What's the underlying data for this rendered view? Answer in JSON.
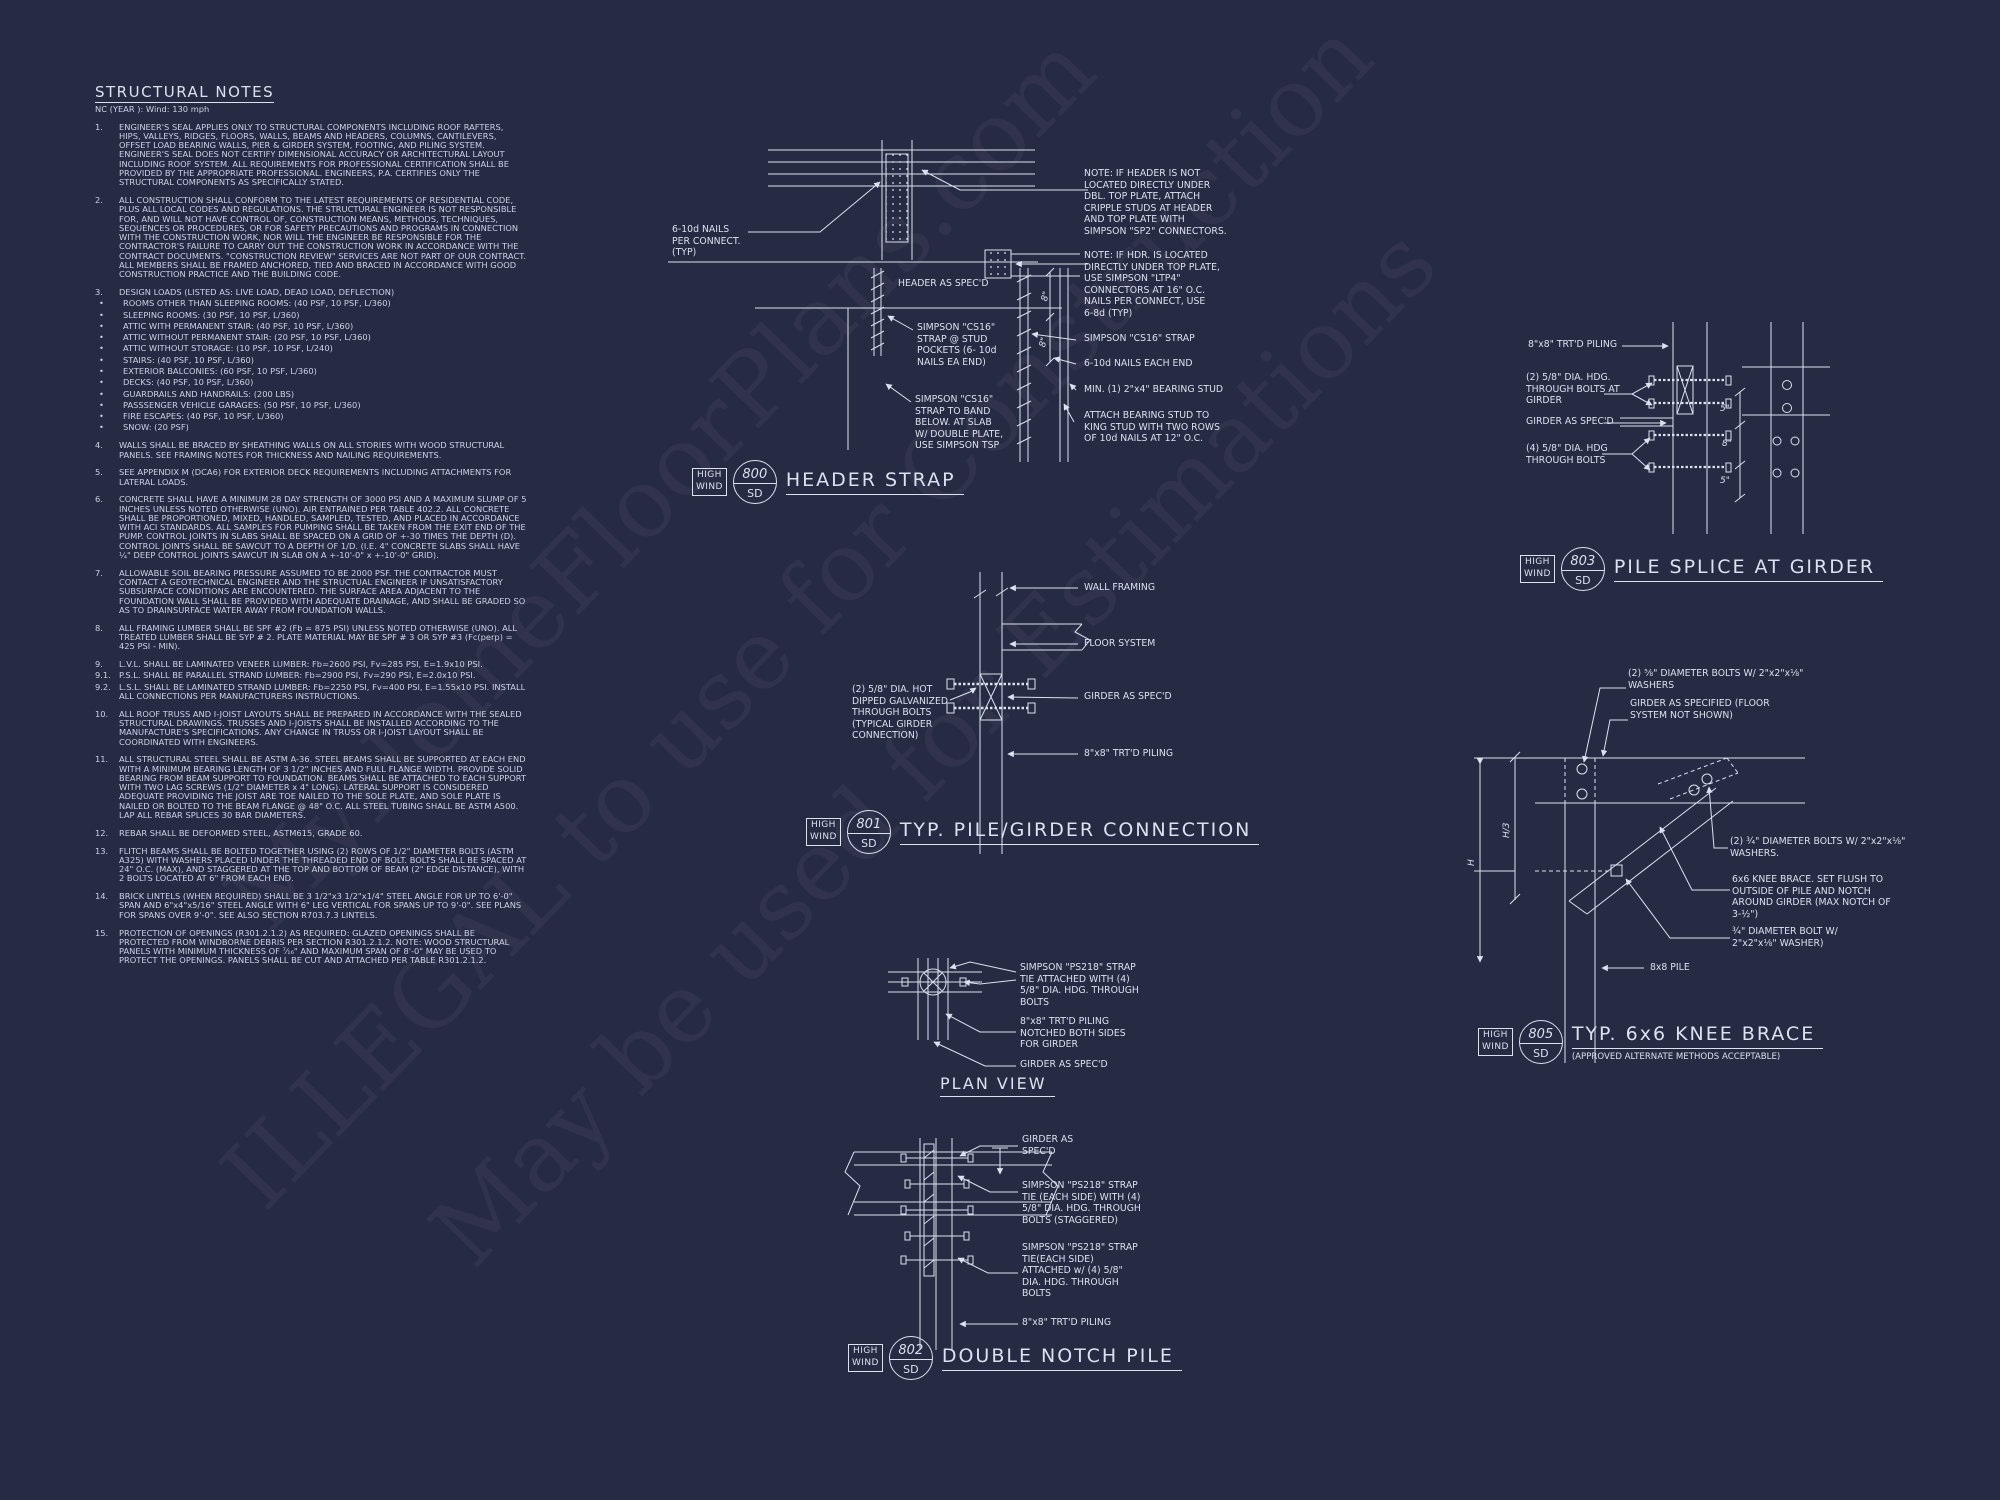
{
  "page": {
    "bg": "#262a42",
    "ink": "#dce1ef"
  },
  "watermark": {
    "lines": [
      "MyHomeFloorPlans.com",
      "ILLEGAL to use for Construction",
      "May be used for Estimations"
    ]
  },
  "bubble_tag": {
    "top": "HIGH",
    "bottom": "WIND",
    "sheet": "SD"
  },
  "notes": {
    "title": "STRUCTURAL NOTES",
    "subtitle": "NC (YEAR ): Wind: 130 mph",
    "items": [
      {
        "type": "n",
        "num": "1.",
        "text": "ENGINEER'S SEAL APPLIES ONLY TO STRUCTURAL COMPONENTS INCLUDING ROOF RAFTERS, HIPS, VALLEYS, RIDGES, FLOORS, WALLS, BEAMS AND HEADERS, COLUMNS, CANTILEVERS, OFFSET LOAD BEARING WALLS, PIER & GIRDER SYSTEM, FOOTING, AND PILING SYSTEM.  ENGINEER'S SEAL DOES NOT CERTIFY DIMENSIONAL ACCURACY OR ARCHITECTURAL LAYOUT INCLUDING ROOF SYSTEM. ALL REQUIREMENTS FOR PROFESSIONAL CERTIFICATION SHALL BE PROVIDED BY THE APPROPRIATE PROFESSIONAL.  ENGINEERS, P.A. CERTIFIES ONLY THE STRUCTURAL COMPONENTS AS SPECIFICALLY STATED."
      },
      {
        "type": "n",
        "num": "2.",
        "text": "ALL CONSTRUCTION SHALL CONFORM TO THE LATEST REQUIREMENTS OF RESIDENTIAL CODE, PLUS ALL LOCAL CODES AND REGULATIONS. THE STRUCTURAL ENGINEER IS NOT RESPONSIBLE FOR, AND WILL NOT HAVE CONTROL OF, CONSTRUCTION MEANS, METHODS, TECHNIQUES, SEQUENCES OR PROCEDURES, OR FOR SAFETY PRECAUTIONS AND PROGRAMS IN CONNECTION WITH THE CONSTRUCTION WORK, NOR WILL THE ENGINEER BE RESPONSIBLE FOR THE CONTRACTOR'S FAILURE TO CARRY OUT THE CONSTRUCTION WORK IN ACCORDANCE WITH THE CONTRACT DOCUMENTS. \"CONSTRUCTION REVIEW\" SERVICES ARE NOT PART OF OUR CONTRACT. ALL MEMBERS SHALL BE FRAMED ANCHORED, TIED AND BRACED IN ACCORDANCE WITH GOOD CONSTRUCTION PRACTICE AND THE BUILDING CODE."
      },
      {
        "type": "n",
        "num": "3.",
        "text": "DESIGN LOADS (LISTED AS: LIVE LOAD, DEAD LOAD, DEFLECTION)"
      },
      {
        "type": "b",
        "num": "•",
        "text": "ROOMS OTHER THAN SLEEPING ROOMS: (40 PSF, 10 PSF, L/360)"
      },
      {
        "type": "b",
        "num": "•",
        "text": "SLEEPING ROOMS: (30 PSF, 10 PSF, L/360)"
      },
      {
        "type": "b",
        "num": "•",
        "text": "ATTIC WITH PERMANENT STAIR: (40 PSF, 10 PSF, L/360)"
      },
      {
        "type": "b",
        "num": "•",
        "text": "ATTIC WITHOUT PERMANENT STAIR: (20 PSF, 10 PSF, L/360)"
      },
      {
        "type": "b",
        "num": "•",
        "text": "ATTIC WITHOUT STORAGE: (10 PSF, 10 PSF, L/240)"
      },
      {
        "type": "b",
        "num": "•",
        "text": "STAIRS: (40 PSF, 10 PSF, L/360)"
      },
      {
        "type": "b",
        "num": "•",
        "text": "EXTERIOR BALCONIES: (60 PSF, 10 PSF, L/360)"
      },
      {
        "type": "b",
        "num": "•",
        "text": "DECKS: (40 PSF, 10 PSF, L/360)"
      },
      {
        "type": "b",
        "num": "•",
        "text": "GUARDRAILS AND HANDRAILS: (200 LBS)"
      },
      {
        "type": "b",
        "num": "•",
        "text": "PASSSENGER VEHICLE GARAGES: (50 PSF, 10 PSF, L/360)"
      },
      {
        "type": "b",
        "num": "•",
        "text": "FIRE ESCAPES: (40 PSF, 10 PSF, L/360)"
      },
      {
        "type": "b",
        "num": "•",
        "text": "SNOW: (20 PSF)"
      },
      {
        "type": "n",
        "num": "4.",
        "text": "WALLS SHALL BE BRACED BY SHEATHING WALLS ON ALL STORIES WITH WOOD STRUCTURAL PANELS. SEE FRAMING NOTES FOR THICKNESS AND NAILING REQUIREMENTS."
      },
      {
        "type": "n",
        "num": "5.",
        "text": "SEE APPENDIX M (DCA6) FOR EXTERIOR DECK REQUIREMENTS INCLUDING ATTACHMENTS FOR LATERAL LOADS."
      },
      {
        "type": "n",
        "num": "6.",
        "text": "CONCRETE SHALL HAVE A MINIMUM 28 DAY STRENGTH OF 3000 PSI AND A MAXIMUM SLUMP OF 5 INCHES UNLESS NOTED OTHERWISE (UNO). AIR ENTRAINED PER TABLE 402.2. ALL CONCRETE SHALL BE PROPORTIONED, MIXED, HANDLED, SAMPLED, TESTED, AND PLACED IN ACCORDANCE WITH ACI STANDARDS. ALL SAMPLES FOR PUMPING SHALL BE TAKEN FROM THE EXIT END OF THE PUMP. CONTROL JOINTS IN SLABS SHALL BE SPACED ON A GRID OF +-30 TIMES THE DEPTH (D). CONTROL JOINTS SHALL BE SAWCUT TO A DEPTH OF 1/D. (I.E. 4\" CONCRETE SLABS SHALL HAVE ¼\" DEEP CONTROL JOINTS SAWCUT IN SLAB ON A +-10'-0\" x +-10'-0\" GRID)."
      },
      {
        "type": "n",
        "num": "7.",
        "text": "ALLOWABLE SOIL BEARING PRESSURE ASSUMED TO BE 2000 PSF. THE CONTRACTOR MUST CONTACT A GEOTECHNICAL ENGINEER AND THE STRUCTUAL ENGINEER IF UNSATISFACTORY SUBSURFACE CONDITIONS ARE ENCOUNTERED. THE SURFACE AREA ADJACENT TO THE FOUNDATION WALL SHALL BE PROVIDED WITH ADEQUATE DRAINAGE, AND SHALL BE GRADED SO AS TO DRAINSURFACE WATER AWAY FROM FOUNDATION WALLS."
      },
      {
        "type": "n",
        "num": "8.",
        "text": "ALL FRAMING LUMBER SHALL BE SPF #2 (Fb = 875 PSI) UNLESS NOTED OTHERWISE (UNO). ALL TREATED LUMBER SHALL BE SYP # 2. PLATE MATERIAL MAY BE SPF # 3 OR SYP #3 (Fc(perp) = 425 PSI - MIN)."
      },
      {
        "type": "n",
        "num": "9.",
        "text": "L.V.L.  SHALL BE LAMINATED VENEER LUMBER: Fb=2600 PSI, Fv=285 PSI, E=1.9x10  PSI."
      },
      {
        "type": "s",
        "num": "9.1.",
        "text": "P.S.L.  SHALL BE PARALLEL STRAND LUMBER: Fb=2900 PSI, Fv=290 PSI, E=2.0x10  PSI."
      },
      {
        "type": "s",
        "num": "9.2.",
        "text": "L.S.L.  SHALL BE LAMINATED STRAND LUMBER: Fb=2250 PSI, Fv=400 PSI, E=1.55x10  PSI. INSTALL ALL CONNECTIONS PER MANUFACTURERS INSTRUCTIONS."
      },
      {
        "type": "n",
        "num": "10.",
        "text": "ALL ROOF TRUSS AND I-JOIST LAYOUTS SHALL BE PREPARED IN ACCORDANCE WITH THE SEALED STRUCTURAL DRAWINGS. TRUSSES AND I-JOISTS SHALL BE INSTALLED ACCORDING TO THE MANUFACTURE'S SPECIFICATIONS. ANY CHANGE IN TRUSS OR I-JOIST LAYOUT SHALL BE COORDINATED WITH  ENGINEERS."
      },
      {
        "type": "n",
        "num": "11.",
        "text": "ALL STRUCTURAL STEEL SHALL BE ASTM A-36. STEEL BEAMS SHALL BE SUPPORTED AT EACH END WITH A MINIMUM BEARING LENGTH OF 3 1/2\" INCHES AND FULL FLANGE WIDTH. PROVIDE SOLID BEARING FROM BEAM SUPPORT TO FOUNDATION.  BEAMS SHALL BE ATTACHED TO EACH SUPPORT WITH TWO LAG SCREWS (1/2\" DIAMETER x 4\" LONG). LATERAL SUPPORT IS CONSIDERED ADEQUATE PROVIDING THE JOIST ARE TOE NAILED TO THE SOLE PLATE, AND SOLE PLATE IS NAILED OR BOLTED TO THE BEAM FLANGE @ 48\" O.C. ALL STEEL TUBING SHALL BE ASTM A500. LAP ALL REBAR SPLICES 30 BAR DIAMETERS."
      },
      {
        "type": "n",
        "num": "12.",
        "text": "REBAR SHALL BE DEFORMED STEEL, ASTM615, GRADE 60."
      },
      {
        "type": "n",
        "num": "13.",
        "text": "FLITCH BEAMS SHALL BE BOLTED TOGETHER USING (2) ROWS OF 1/2\" DIAMETER BOLTS (ASTM A325) WITH WASHERS PLACED UNDER THE THREADED END OF BOLT. BOLTS SHALL BE SPACED AT 24\" O.C. (MAX), AND STAGGERED AT THE TOP AND BOTTOM OF BEAM (2\" EDGE DISTANCE), WITH 2 BOLTS LOCATED AT 6\" FROM EACH END."
      },
      {
        "type": "n",
        "num": "14.",
        "text": "BRICK LINTELS (WHEN REQUIRED) SHALL BE 3 1/2\"x3 1/2\"x1/4\" STEEL ANGLE FOR UP TO 6'-0\" SPAN AND 6\"x4\"x5/16\" STEEL ANGLE WITH 6\" LEG VERTICAL FOR SPANS UP TO 9'-0\". SEE PLANS FOR SPANS OVER 9'-0\". SEE ALSO SECTION R703.7.3 LINTELS."
      },
      {
        "type": "n",
        "num": "15.",
        "text": "PROTECTION OF OPENINGS (R301.2.1.2) AS REQUIRED: GLAZED OPENINGS SHALL BE PROTECTED FROM WINDBORNE DEBRIS PER SECTION R301.2.1.2. NOTE: WOOD STRUCTURAL PANELS WITH MINIMUM THICKNESS OF ⁷⁄₁₆\" AND MAXIMUM SPAN OF 8'-0\" MAY BE USED TO PROTECT THE OPENINGS. PANELS SHALL BE CUT AND ATTACHED PER TABLE R301.2.1.2."
      }
    ]
  },
  "details": {
    "header_strap": {
      "num": "800",
      "title": "HEADER STRAP",
      "labels": {
        "nails": "6-10d NAILS\nPER CONNECT.\n(TYP)",
        "note1": "NOTE: IF HEADER IS NOT\nLOCATED DIRECTLY UNDER\nDBL. TOP PLATE, ATTACH\nCRIPPLE STUDS AT HEADER\nAND TOP PLATE WITH\nSIMPSON \"SP2\" CONNECTORS.",
        "note2": "NOTE: IF HDR. IS LOCATED\nDIRECTLY UNDER TOP PLATE,\nUSE SIMPSON \"LTP4\"\nCONNECTORS AT 16\" O.C.\nNAILS PER CONNECT, USE\n6-8d (TYP)",
        "header_specd": "HEADER AS SPEC'D",
        "cs16_strap": "SIMPSON \"CS16\" STRAP",
        "nails_each_end": "6-10d NAILS  EACH END",
        "bearing_stud": "MIN. (1) 2\"x4\" BEARING STUD",
        "attach_stud": "ATTACH BEARING  STUD TO\nKING STUD WITH TWO ROWS\nOF 10d NAILS AT 12\" O.C.",
        "stud_pockets": "SIMPSON \"CS16\"\nSTRAP @ STUD\nPOCKETS (6- 10d\nNAILS EA END)",
        "band_below": "SIMPSON \"CS16\"\nSTRAP TO BAND\nBELOW. AT SLAB\nW/ DOUBLE PLATE,\nUSE SIMPSON TSP",
        "dim_8": "8\""
      }
    },
    "pile_girder": {
      "num": "801",
      "title": "TYP. PILE/GIRDER CONNECTION",
      "labels": {
        "bolts": "(2) 5/8\" DIA. HOT\nDIPPED GALVANIZED\nTHROUGH BOLTS\n(TYPICAL GIRDER\nCONNECTION)",
        "wall_framing": "WALL FRAMING",
        "floor_system": "FLOOR SYSTEM",
        "girder": "GIRDER AS SPEC'D",
        "piling": "8\"x8\" TRT'D PILING"
      }
    },
    "plan_view": {
      "title": "PLAN VIEW",
      "labels": {
        "strap": "SIMPSON \"PS218\" STRAP\nTIE ATTACHED WITH (4)\n5/8\" DIA. HDG. THROUGH\nBOLTS",
        "piling": "8\"x8\" TRT'D PILING\nNOTCHED BOTH SIDES\nFOR GIRDER",
        "girder": "GIRDER AS SPEC'D"
      }
    },
    "double_notch": {
      "num": "802",
      "title": "DOUBLE NOTCH PILE",
      "labels": {
        "girder": "GIRDER AS\nSPEC'D",
        "strap1": "SIMPSON \"PS218\" STRAP\nTIE (EACH SIDE) WITH (4)\n5/8\" DIA. HDG. THROUGH\nBOLTS (STAGGERED)",
        "strap2": "SIMPSON \"PS218\" STRAP\nTIE(EACH SIDE)\nATTACHED w/ (4) 5/8\"\nDIA. HDG. THROUGH\nBOLTS",
        "piling": "8\"x8\" TRT'D PILING"
      }
    },
    "pile_splice": {
      "num": "803",
      "title": "PILE SPLICE AT GIRDER",
      "labels": {
        "piling": "8\"x8\" TRT'D PILING",
        "bolts2": "(2) 5/8\" DIA.  HDG.\nTHROUGH BOLTS AT\nGIRDER",
        "girder": "GIRDER AS SPEC'D",
        "bolts4": "(4) 5/8\" DIA. HDG\nTHROUGH BOLTS",
        "dim_top": "5\"",
        "dim_mid": "8\"",
        "dim_bot": "5\""
      }
    },
    "knee_brace": {
      "num": "805",
      "title": "TYP. 6x6 KNEE BRACE",
      "subtitle": "(APPROVED ALTERNATE METHODS ACCEPTABLE)",
      "labels": {
        "bolts58": "(2) ⅝\" DIAMETER BOLTS W/ 2\"x2\"x⅛\"\nWASHERS",
        "girder": "GIRDER AS SPECIFIED (FLOOR\nSYSTEM NOT SHOWN)",
        "bolts34": "(2) ¾\" DIAMETER BOLTS W/ 2\"x2\"x⅛\"\nWASHERS.",
        "brace": "6x6 KNEE BRACE. SET FLUSH TO\nOUTSIDE OF PILE AND NOTCH\nAROUND GIRDER (MAX NOTCH OF\n3-½\")",
        "bolt34": "¾\" DIAMETER BOLT W/\n2\"x2\"x⅛\" WASHER)",
        "pile": "8x8 PILE",
        "dim_h": "H",
        "dim_h3": "H/3"
      }
    }
  }
}
